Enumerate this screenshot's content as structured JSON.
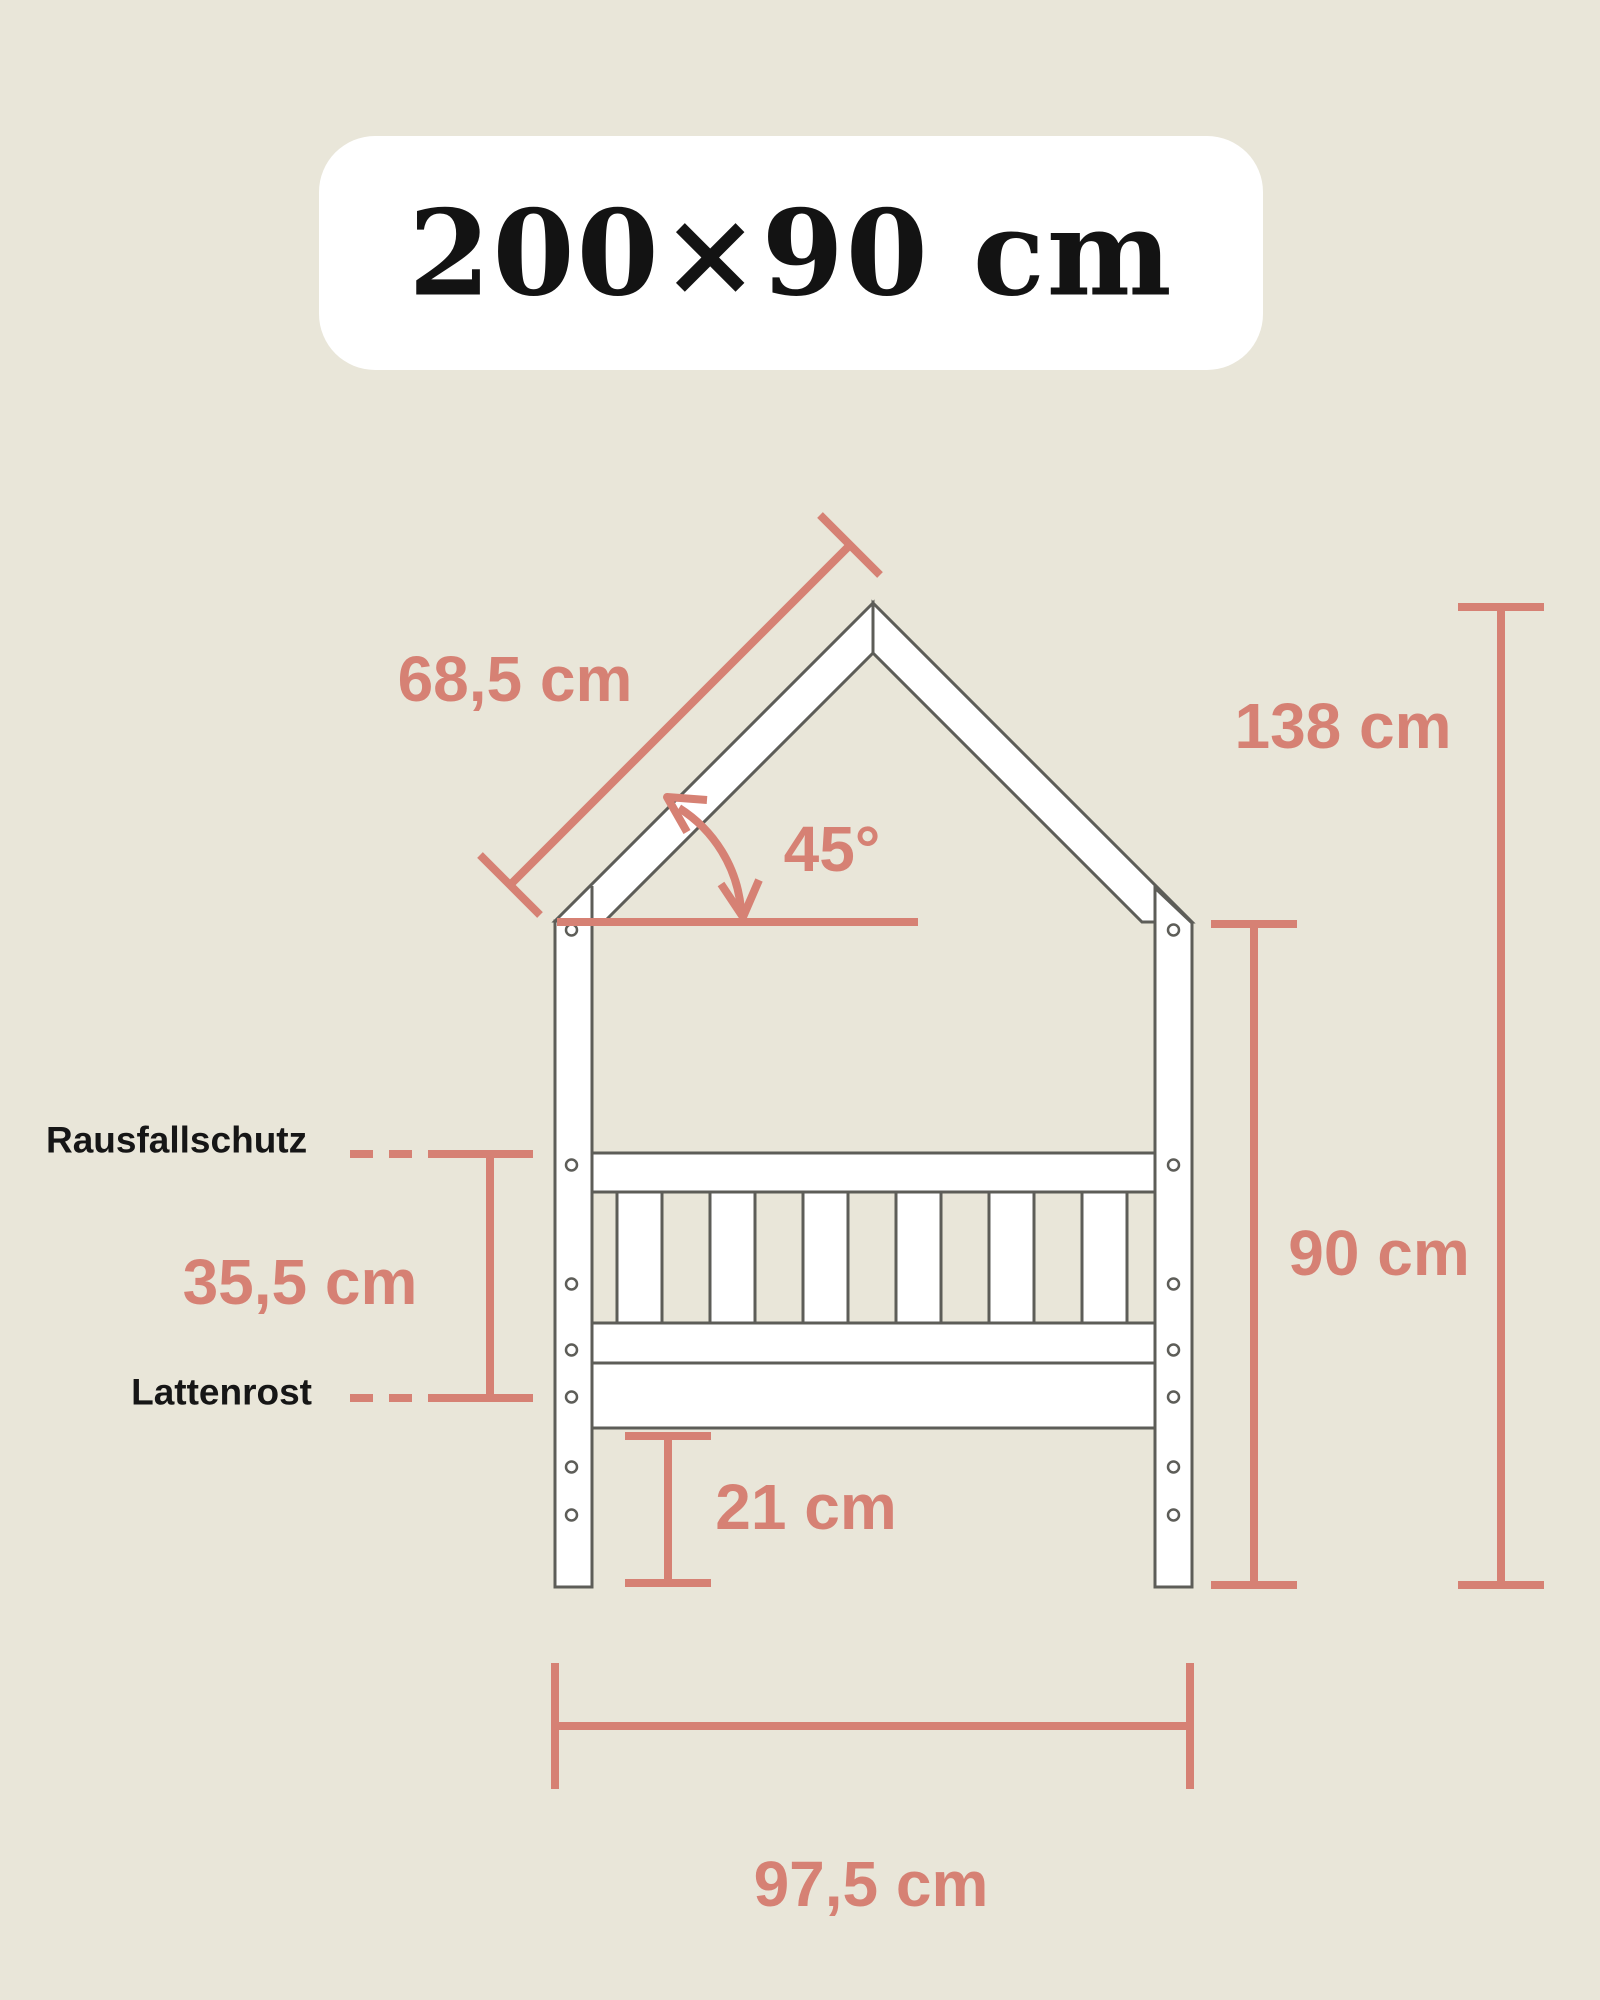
{
  "colors": {
    "background": "#e9e6d9",
    "accent": "#d68174",
    "outline": "#5d5d58",
    "ink": "#161616",
    "card": "#ffffff"
  },
  "badge": {
    "label": "200×90 cm"
  },
  "annotations": {
    "roof_side_length": "68,5 cm",
    "roof_angle": "45°",
    "total_height": "138 cm",
    "frame_height": "90 cm",
    "guard_to_slats": "35,5 cm",
    "under_bed_clearance": "21 cm",
    "outer_width": "97,5 cm"
  },
  "part_labels": {
    "fall_protection": "Rausfallschutz",
    "slatted_base": "Lattenrost"
  },
  "structure": {
    "slat_count": 6,
    "screw_holes_per_post": 7
  }
}
